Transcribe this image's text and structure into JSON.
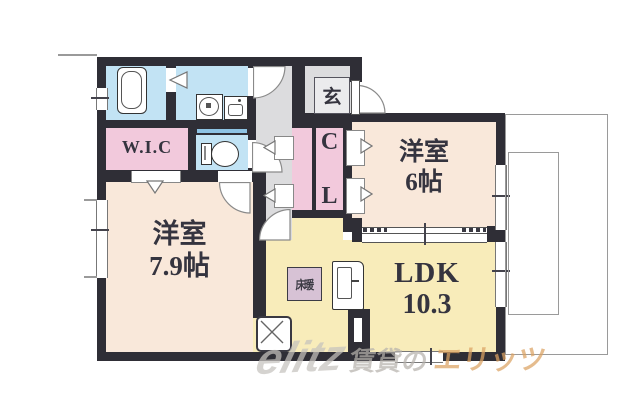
{
  "floorplan": {
    "rooms": {
      "wic": {
        "label": "W.I.C"
      },
      "genkan": {
        "label": "玄"
      },
      "closet": {
        "chars": [
          "C",
          "L"
        ]
      },
      "bedroom6": {
        "name": "洋室",
        "size": "6帖"
      },
      "bedroom79": {
        "name": "洋室",
        "size": "7.9帖"
      },
      "ldk": {
        "name": "LDK",
        "size": "10.3"
      },
      "floor_heating": {
        "label": "床暖"
      }
    },
    "colors": {
      "wall": "#2f2e36",
      "western_room": "#f9e8da",
      "ldk": "#f8ecba",
      "closet_pink": "#f2c9dc",
      "wet_area_blue": "#c2e3f4",
      "hallway_grey": "#dcdcde",
      "watermark_accent": "#dca363"
    }
  },
  "watermark": {
    "logo": "elitz",
    "text_grey": "賃貸の",
    "text_orange": "エリッツ"
  }
}
